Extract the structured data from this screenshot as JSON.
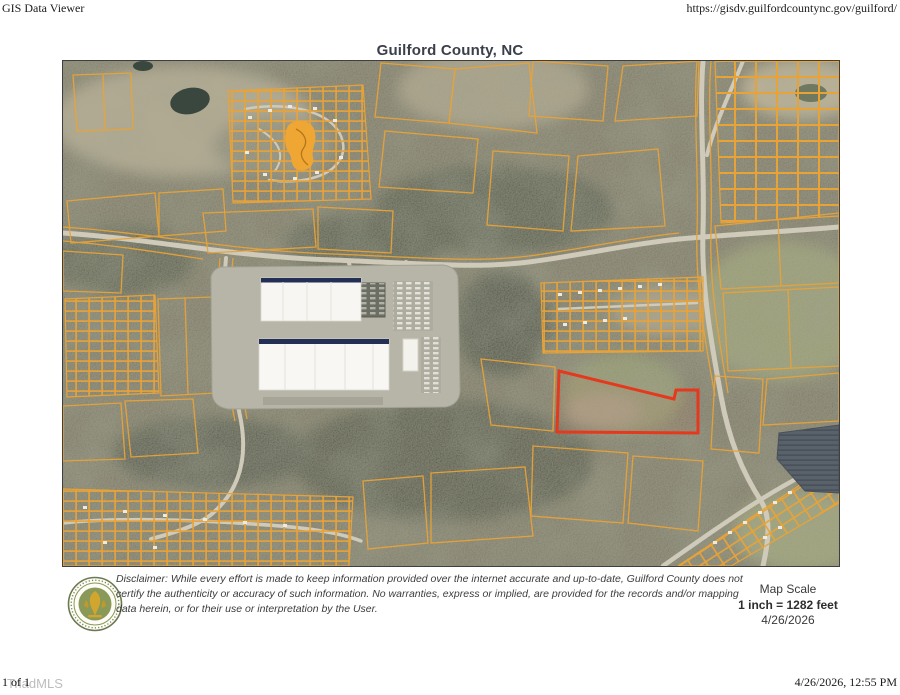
{
  "print_header": {
    "app_title": "GIS Data Viewer",
    "url": "https://gisdv.guilfordcountync.gov/guilford/"
  },
  "map": {
    "title": "Guilford County, NC",
    "colors": {
      "parcel_line": "#e8a338",
      "highlight_parcel_stroke": "#e5391d",
      "subdivision_highlight_fill": "#f2a630",
      "aerial_base": "#7b7963",
      "road": "#cfcaba",
      "solar_farm": "#59616b"
    }
  },
  "footer_bar": {
    "disclaimer": "Disclaimer: While every effort is made to keep information provided over the internet accurate and up-to-date, Guilford County does not certify the authenticity or accuracy of such information. No warranties, express or implied, are provided for the records and/or mapping data herein, or for their use or interpretation by the User.",
    "map_scale": {
      "label": "Map Scale",
      "value": "1 inch = 1282 feet",
      "date": "4/26/2026"
    }
  },
  "print_footer": {
    "page_number": "1 of 1",
    "watermark": "TriadMLS",
    "timestamp": "4/26/2026, 12:55 PM"
  }
}
